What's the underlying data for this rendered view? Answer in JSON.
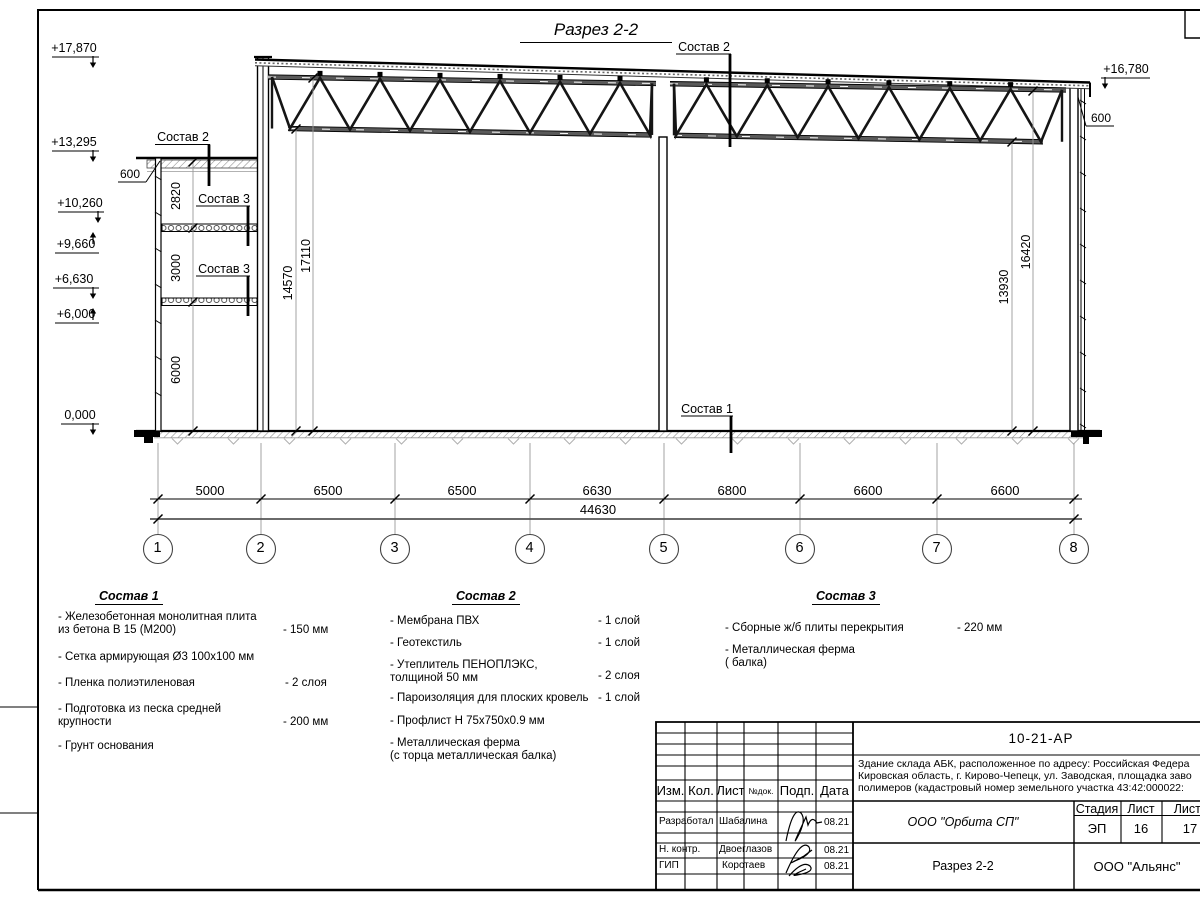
{
  "drawing": {
    "title": "Разрез 2-2",
    "elev": {
      "e17870": "+17,870",
      "e13295": "+13,295",
      "e10260": "+10,260",
      "e9660": "+9,660",
      "e6630": "+6,630",
      "e6000": "+6,000",
      "e0": "0,000",
      "e16780": "+16,780"
    },
    "off600_left": "600",
    "off600_right": "600",
    "leaders": {
      "s2_roof": "Состав 2",
      "s2_mezz": "Состав 2",
      "s3_upper": "Состав 3",
      "s3_lower": "Состав 3",
      "s1_floor": "Состав 1"
    },
    "vdims": {
      "v2820": "2820",
      "v3000": "3000",
      "v6000": "6000",
      "v14570": "14570",
      "v17110": "17110",
      "v13930": "13930",
      "v16420": "16420"
    },
    "spans": [
      "5000",
      "6500",
      "6500",
      "6630",
      "6800",
      "6600",
      "6600"
    ],
    "total": "44630",
    "axes": [
      "1",
      "2",
      "3",
      "4",
      "5",
      "6",
      "7",
      "8"
    ]
  },
  "legends": [
    {
      "header": "Состав 1",
      "items": [
        {
          "name": "- Железобетонная  монолитная плита\nиз бетона В 15 (М200)",
          "value": "- 150 мм"
        },
        {
          "name": "- Сетка армирующая Ø3 100х100 мм",
          "value": ""
        },
        {
          "name": "- Пленка полиэтиленовая",
          "value": "- 2 слоя"
        },
        {
          "name": "- Подготовка из песка средней\nкрупности",
          "value": "- 200 мм"
        },
        {
          "name": "- Грунт основания",
          "value": ""
        }
      ]
    },
    {
      "header": "Состав 2",
      "items": [
        {
          "name": "- Мембрана ПВХ",
          "value": "- 1 слой"
        },
        {
          "name": "- Геотекстиль",
          "value": "- 1 слой"
        },
        {
          "name": "- Утеплитель ПЕНОПЛЭКС,\nтолщиной 50 мм",
          "value": "- 2 слоя"
        },
        {
          "name": "- Пароизоляция для плоских кровель",
          "value": "- 1 слой"
        },
        {
          "name": "- Профлист Н 75х750х0.9 мм",
          "value": ""
        },
        {
          "name": "- Металлическая ферма\n(с торца металлическая балка)",
          "value": ""
        }
      ]
    },
    {
      "header": "Состав 3",
      "items": [
        {
          "name": "- Сборные ж/б плиты перекрытия",
          "value": "- 220 мм"
        },
        {
          "name": "- Металлическая ферма\n( балка)",
          "value": ""
        }
      ]
    }
  ],
  "title_block": {
    "doc_number": "10-21-АР",
    "description": "Здание склада АБК, расположенное по адресу: Российская Федера\nКировская область, г. Кирово-Чепецк, ул. Заводская, площадка заво\nполимеров (кадастровый номер земельного участка 43:42:000022:",
    "cols": {
      "izm": "Изм.",
      "kol": "Кол.",
      "list": "Лист",
      "ndoc": "№док.",
      "podp": "Подп.",
      "data": "Дата"
    },
    "rows": [
      {
        "role": "Разработал",
        "name": "Шабалина",
        "date": "08.21"
      },
      {
        "role": "Н. контр.",
        "name": "Двоеглазов",
        "date": "08.21"
      },
      {
        "role": "ГИП",
        "name": "Коротаев",
        "date": "08.21"
      }
    ],
    "company": "ООО \"Орбита СП\"",
    "sheet_name": "Разрез 2-2",
    "stage_label": "Стадия",
    "stage": "ЭП",
    "list_label": "Лист",
    "list": "16",
    "listov_label": "Листов",
    "listov": "17",
    "firm": "ООО \"Альянс\""
  }
}
